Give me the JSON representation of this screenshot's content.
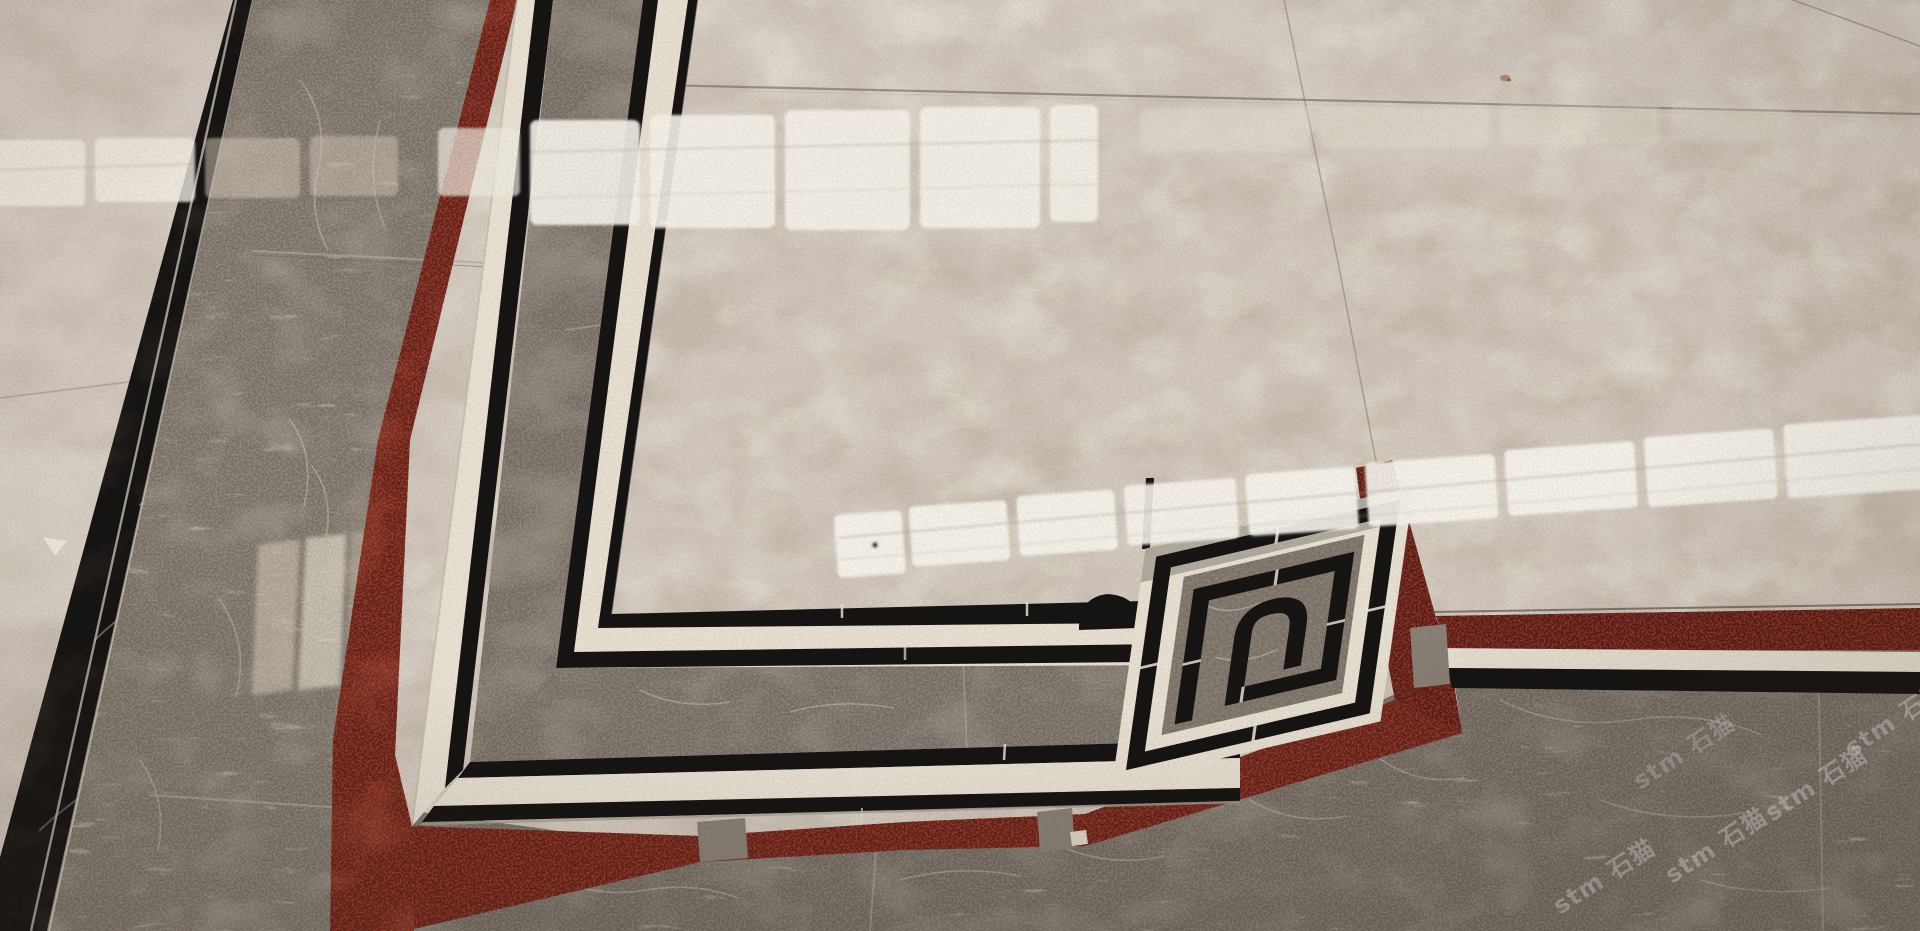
{
  "meta": {
    "type": "photograph",
    "subject": "Polished marble floor tiles dry-laid over red matting: beige field tiles with a waterjet border of black inlay lines, grey marble bands, cream strips and a Greek-key corner ornament, with ceiling light reflections",
    "camera": "oblique perspective, indoor showroom lighting"
  },
  "palette": {
    "beige_field": "#d4cabf",
    "beige_outer_tile": "#d7cdc3",
    "cream_strip": "#e9e1d2",
    "black_inlay": "#171514",
    "grey_band_left": "#8f867c",
    "grey_band_inner": "#8a8177",
    "grey_field_bottom": "#857c73",
    "ornament_ground": "#8d8378",
    "red_mat": "#94392c",
    "red_mat_dark": "#5a2019",
    "reflection_bright": "#f8f4eb",
    "tile_edge_silver": "#c9c1b6"
  },
  "regions": [
    {
      "name": "left-outer-beige-tile",
      "material": "beige marble"
    },
    {
      "name": "left-black-inlay-strip",
      "material": "nero marquina marble"
    },
    {
      "name": "left-grey-border-band",
      "material": "grey emperador marble"
    },
    {
      "name": "red-mat-gaps",
      "material": "red coil matting visible between tiles"
    },
    {
      "name": "cream-strips",
      "material": "cream marble"
    },
    {
      "name": "double-line-inner-frame",
      "material": "black marble inlay lines"
    },
    {
      "name": "greek-key-corner-ornament",
      "material": "waterjet medallion corner"
    },
    {
      "name": "central-beige-field",
      "material": "beige marble with light reflections"
    },
    {
      "name": "bottom-grey-field",
      "material": "grey marble with watermarks"
    }
  ],
  "watermark": {
    "text": "stm 石猫",
    "instances": [
      {
        "text": "stm 石猫"
      },
      {
        "text": "stm 石猫"
      },
      {
        "text": "stm 石猫"
      },
      {
        "text": "stm 石猫"
      },
      {
        "text": "stm 石猫"
      }
    ]
  }
}
